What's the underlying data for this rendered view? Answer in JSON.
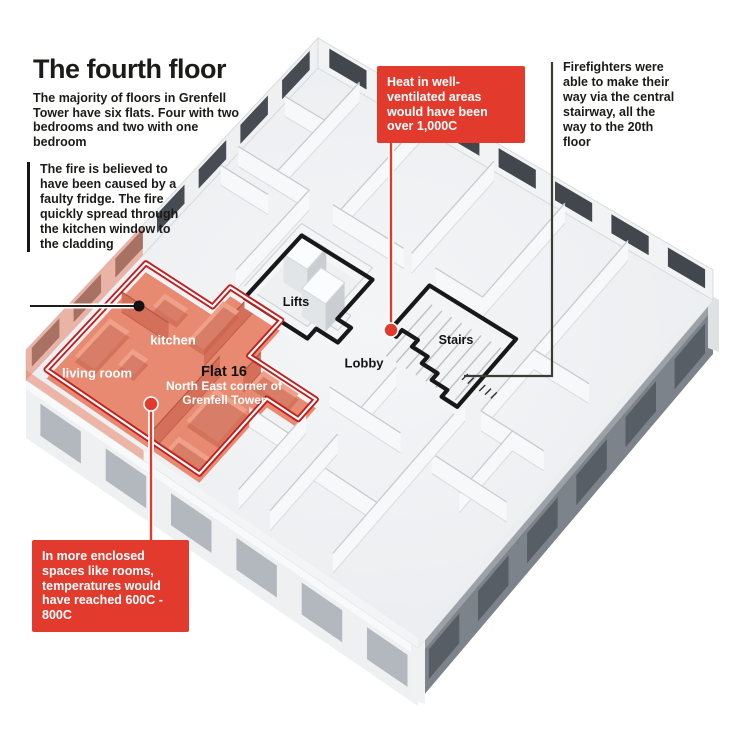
{
  "header": {
    "title": "The fourth floor",
    "subtitle": "The majority of floors in Grenfell Tower have six flats. Four with two bedrooms and two with one bedroom"
  },
  "callouts": {
    "fridge": {
      "text": "The fire is believed to have been caused by a faulty fridge. The fire quickly spread through the kitchen window to the cladding"
    },
    "heat": {
      "text": "Heat in well-ventilated areas would have been ",
      "bold": "over 1,000C"
    },
    "firefighters": {
      "text": "Firefighters were able to make their way via the central stairway, all the way to the 20th floor"
    },
    "enclosed": {
      "text": "In more enclosed spaces like rooms, temperatures would have reached ",
      "bold": "600C - 800C"
    }
  },
  "plan_labels": {
    "kitchen": "kitchen",
    "living_room": "living room",
    "flat16_title": "Flat 16",
    "flat16_line1": "North East corner of",
    "flat16_line2": "Grenfell Tower",
    "lifts": "Lifts",
    "lobby": "Lobby",
    "stairs": "Stairs"
  },
  "colors": {
    "accent_red": "#e23b2e",
    "outline_red": "#c31f1f",
    "flat_fill": "#e78a71",
    "flat_wall": "#d4705a",
    "flat_dark": "#c4604a",
    "glass_dark": "#42464d",
    "wall_white": "#f7f8fa",
    "wall_edge": "#c9ced3",
    "floor": "#e9ebee",
    "facade_light": "#eef0f2",
    "facade_window_light": "#b2b8be",
    "facade_dark": "#7d838a",
    "facade_window_dark": "#585e65",
    "line_dark": "#3c3c35",
    "ink": "#161616"
  }
}
